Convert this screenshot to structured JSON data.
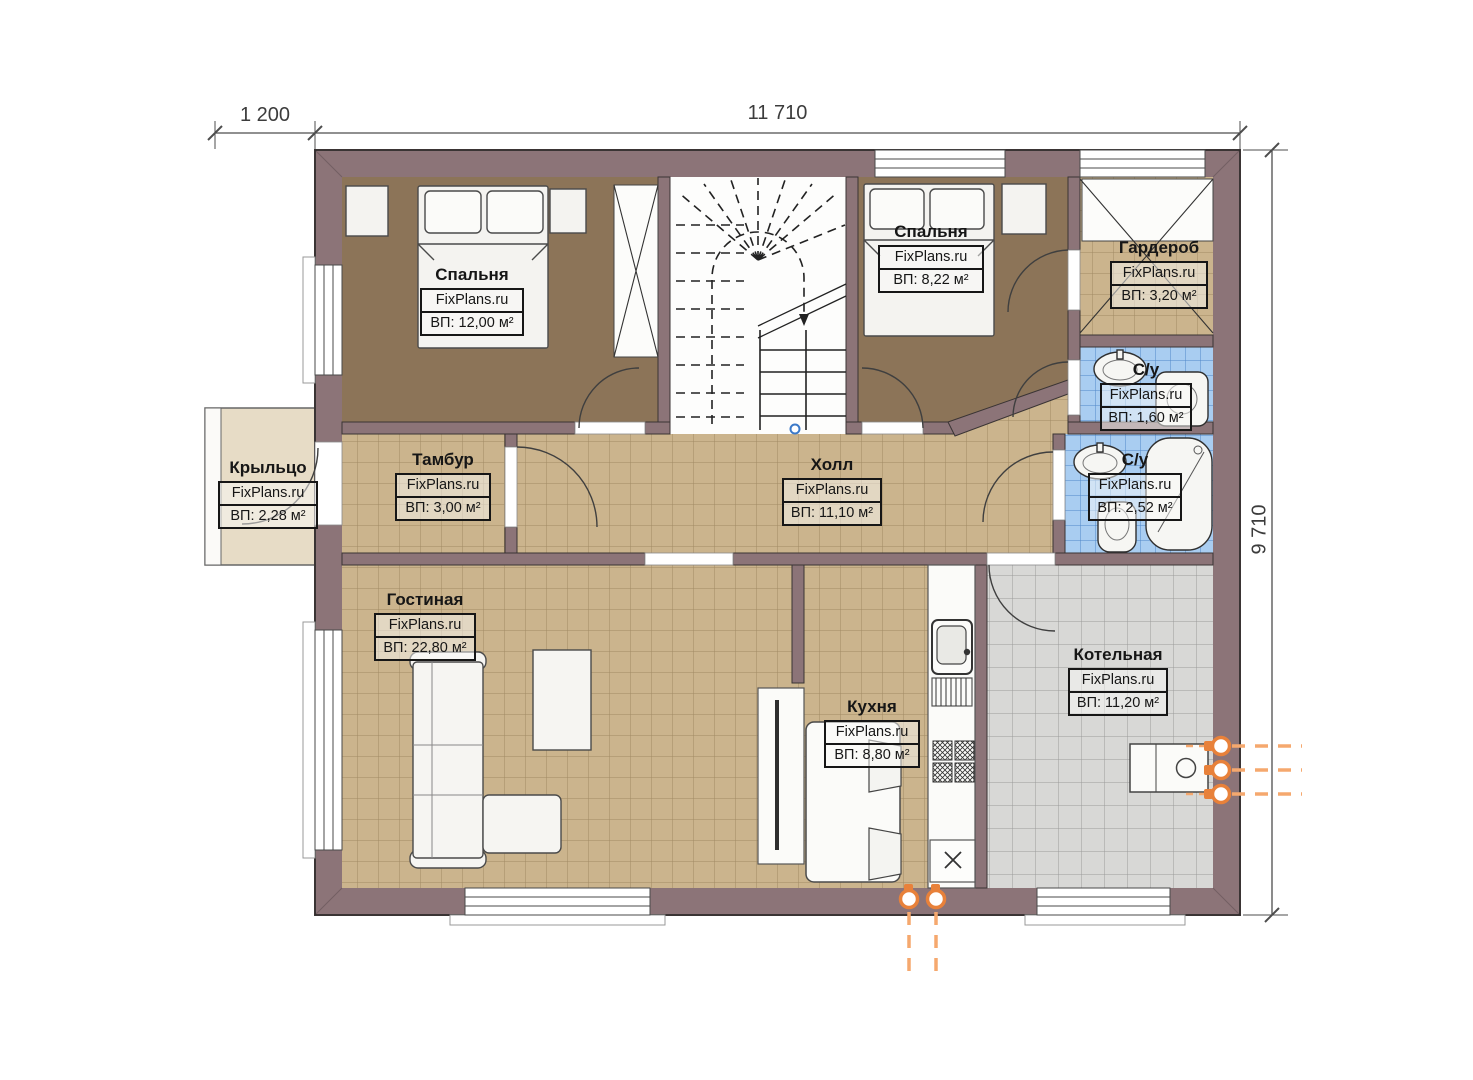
{
  "brand": {
    "label": "FixPlans.ru"
  },
  "dimensions": {
    "top_left": "1 200",
    "top_main": "11 710",
    "right_side": "9 710"
  },
  "rooms": [
    {
      "id": "bedroom-1",
      "name": "Спальня",
      "area": "ВП: 12,00 м²"
    },
    {
      "id": "bedroom-2",
      "name": "Спальня",
      "area": "ВП: 8,22 м²"
    },
    {
      "id": "wardrobe",
      "name": "Гардероб",
      "area": "ВП: 3,20 м²"
    },
    {
      "id": "bathroom-1",
      "name": "С/у",
      "area": "ВП: 1,60 м²"
    },
    {
      "id": "bathroom-2",
      "name": "С/у",
      "area": "ВП: 2,52 м²"
    },
    {
      "id": "porch",
      "name": "Крыльцо",
      "area": "ВП: 2,28 м²"
    },
    {
      "id": "vestibule",
      "name": "Тамбур",
      "area": "ВП: 3,00 м²"
    },
    {
      "id": "hall",
      "name": "Холл",
      "area": "ВП: 11,10 м²"
    },
    {
      "id": "living",
      "name": "Гостиная",
      "area": "ВП: 22,80 м²"
    },
    {
      "id": "kitchen",
      "name": "Кухня",
      "area": "ВП: 8,80 м²"
    },
    {
      "id": "boiler",
      "name": "Котельная",
      "area": "ВП: 11,20 м²"
    }
  ],
  "colors": {
    "wall": "#8c7478",
    "tile_tan": "#cbb48d",
    "tile_blue": "#a9cdf1",
    "tile_gray": "#d8d8d6",
    "bedroom_floor": "#8c7458",
    "porch_floor": "#e7dcc6",
    "utility_orange": "#e8813a",
    "stair_marker_blue": "#3b79c8"
  }
}
